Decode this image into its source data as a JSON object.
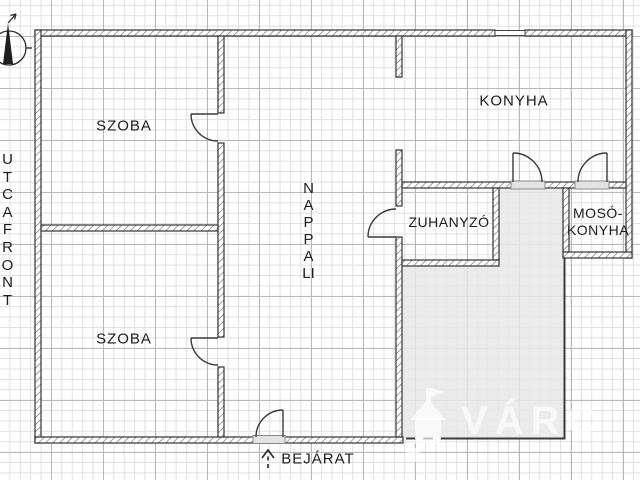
{
  "plan": {
    "type": "floor-plan",
    "orientation_note": "north-arrow top-left"
  },
  "rooms": {
    "szoba_top": {
      "label": "SZOBA"
    },
    "szoba_bottom": {
      "label": "SZOBA"
    },
    "nappali": {
      "label": "NAPPALI"
    },
    "konyha": {
      "label": "KONYHA"
    },
    "zuhanyzo": {
      "label": "ZUHANYZÓ"
    },
    "moso_konyha": {
      "label_line1": "MOSÓ-",
      "label_line2": "KONYHA"
    }
  },
  "annotations": {
    "street_front_label": "UTCAFRONT",
    "entrance_label": "BEJÁRAT"
  },
  "watermark": {
    "text": "VÁRC",
    "logo": "house-logo"
  },
  "icons": {
    "compass": "north-arrow",
    "entrance_arrow": "dashed-up-arrow"
  },
  "colors": {
    "wall_outline": "#333333",
    "grid_minor": "#e0e0e0",
    "grid_major": "#b9b9b9",
    "terrace_fill": "#e8e8e8",
    "text": "#1c1c1c",
    "watermark_text": "rgba(255,255,255,0.65)"
  }
}
